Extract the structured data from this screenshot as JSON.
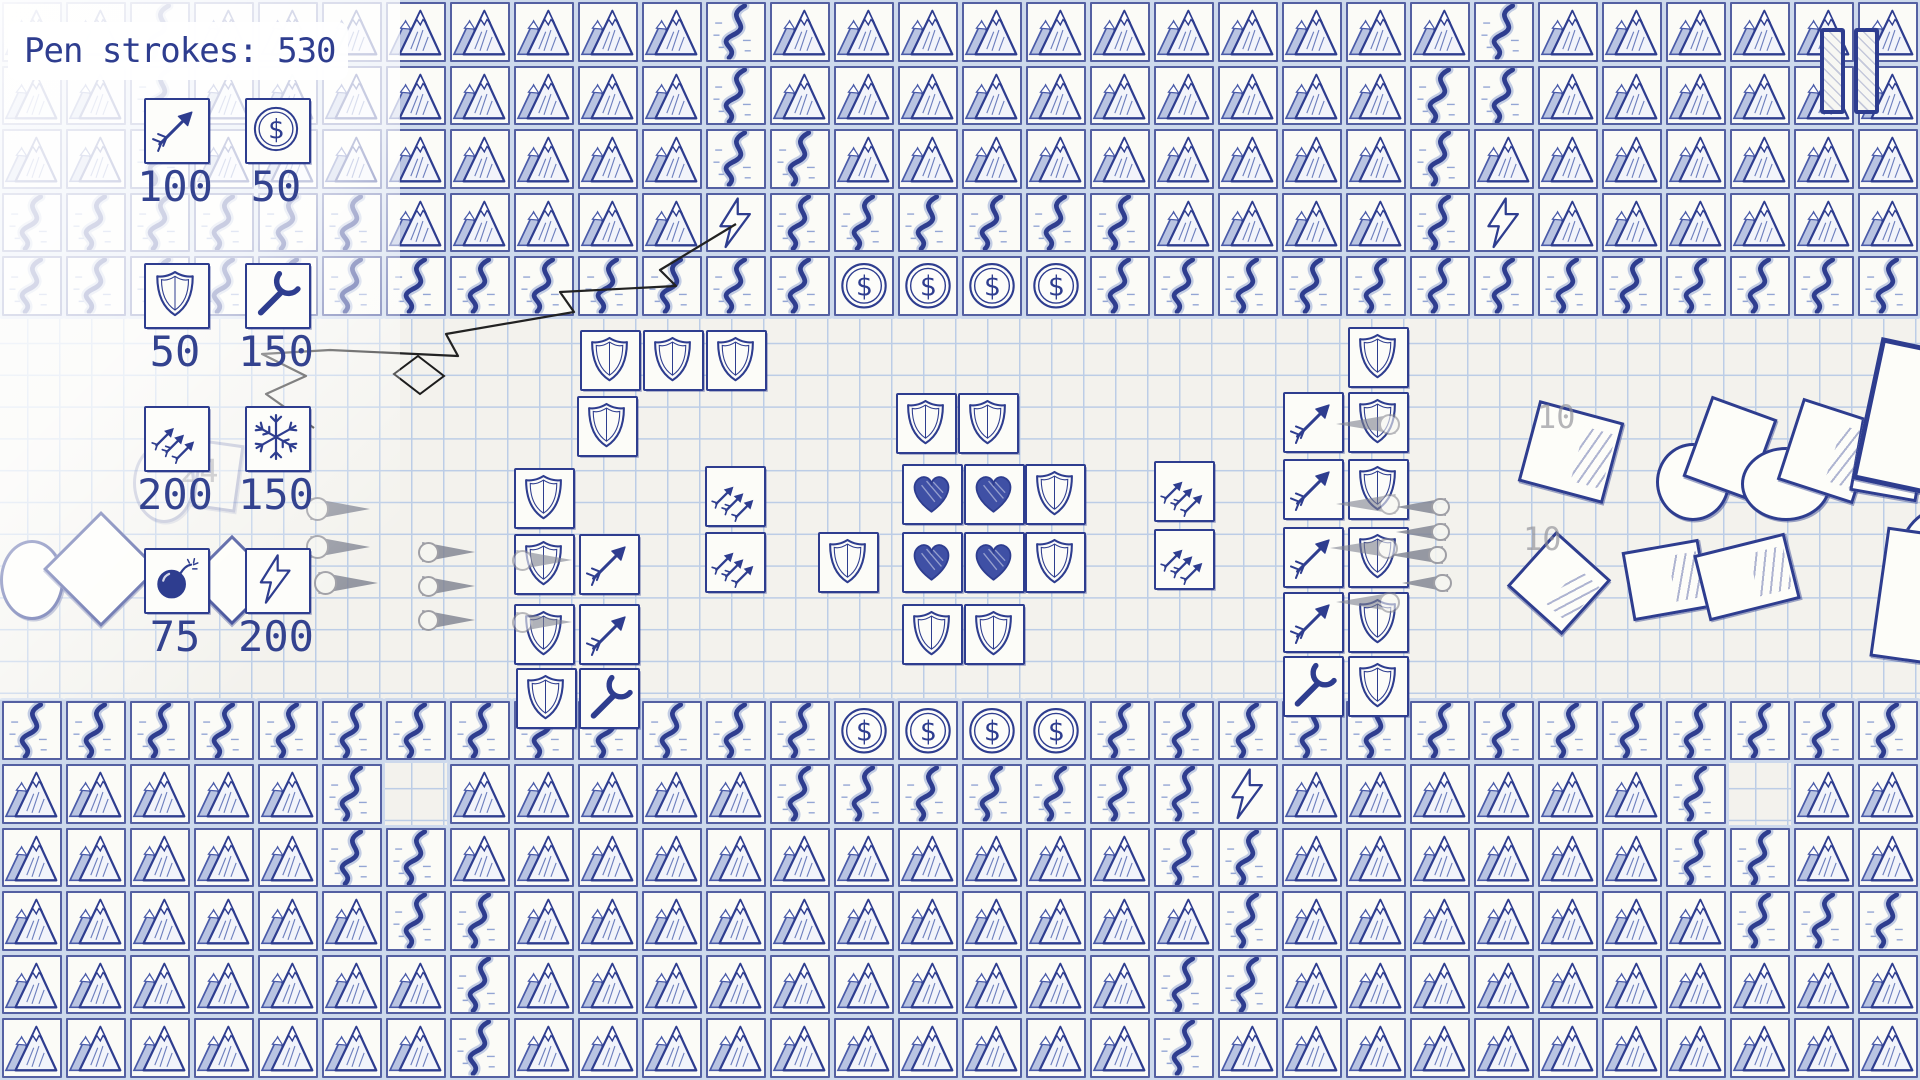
{
  "colors": {
    "ink": "#2e3d8f",
    "paper": "#f3f2ed",
    "grid_line": "#bccde6",
    "tape": "#cdd9ec",
    "dart_gray": "#7e8290",
    "faint_label": "#8f8f96"
  },
  "hud": {
    "pen_strokes": {
      "label": "Pen strokes: ",
      "value": "530"
    },
    "pause": {
      "icon": "pause-icon"
    }
  },
  "shop": {
    "items": [
      {
        "id": "arrow-tower",
        "icon": "arrow-icon",
        "price": "100",
        "x": 144,
        "y": 98
      },
      {
        "id": "coin",
        "icon": "dollar-coin-icon",
        "price": "50",
        "x": 245,
        "y": 98
      },
      {
        "id": "shield-wall",
        "icon": "shield-icon",
        "price": "50",
        "x": 144,
        "y": 263
      },
      {
        "id": "wrench-repair",
        "icon": "wrench-icon",
        "price": "150",
        "x": 245,
        "y": 263
      },
      {
        "id": "multi-arrow-tower",
        "icon": "triple-arrow-icon",
        "price": "200",
        "x": 144,
        "y": 406
      },
      {
        "id": "freeze",
        "icon": "snowflake-icon",
        "price": "150",
        "x": 245,
        "y": 406
      },
      {
        "id": "bomb",
        "icon": "bomb-icon",
        "price": "75",
        "x": 144,
        "y": 548
      },
      {
        "id": "lightning-tower",
        "icon": "lightning-icon",
        "price": "200",
        "x": 245,
        "y": 548
      }
    ]
  },
  "map": {
    "cols": 30,
    "rows": 17,
    "tile_w": 64,
    "tile_h": 63.53,
    "legend": {
      "M": "mountain",
      "R": "river",
      "C": "coin",
      "L": "lightning-tower",
      "P": "paper"
    },
    "grid": [
      "MMRMMMMMMMMRMMMMMMMMMMMRMMMMMM",
      "MMRMMMMMMMMRMMMMMMMMMMRRMMMMMM",
      "MMRMMMMMMMMRRMMMMMMMMMRMMMMMMM",
      "RRRRRRMMMMMLRRRRRRMMMMRLMMMMMM",
      "RRRRRRRRRRRRRCCCCRRRRRRRRRRRRR",
      "PPPPPPPPPPPPPPPPPPPPPPPPPPPPPP",
      "PPPPPPPPPPPPPPPPPPPPPPPPPPPPPP",
      "PPPPPPPPPPPPPPPPPPPPPPPPPPPPPP",
      "PPPPPPPPPPPPPPPPPPPPPPPPPPPPPP",
      "PPPPPPPPPPPPPPPPPPPPPPPPPPPPPP",
      "PPPPPPPPPPPPPPPPPPPPPPPPPPPPPP",
      "RRRRRRRRRRRRRCCCCRRRRRRRRRRRRR",
      "MMMMMRPMMMMMRRRRRRRLMMMMMMRPMM",
      "MMMMMRRMMMMMMMMMMMRRMMMMMMRRMM",
      "MMMMMMRRMMMMMMMMMMMRMMMMMMMRRR",
      "MMMMMMMRMMMMMMMMMMRRMMMMMMMMMM",
      "MMMMMMMRMMMMMMMMMMRMMMMMMMMMMM"
    ]
  },
  "towers": [
    {
      "t": "shield",
      "x": 580,
      "y": 330
    },
    {
      "t": "shield",
      "x": 643,
      "y": 330
    },
    {
      "t": "shield",
      "x": 706,
      "y": 330
    },
    {
      "t": "shield",
      "x": 577,
      "y": 396
    },
    {
      "t": "shield",
      "x": 514,
      "y": 468
    },
    {
      "t": "shield",
      "x": 514,
      "y": 534
    },
    {
      "t": "arrow",
      "x": 579,
      "y": 534
    },
    {
      "t": "shield",
      "x": 514,
      "y": 604
    },
    {
      "t": "arrow",
      "x": 579,
      "y": 604
    },
    {
      "t": "shield",
      "x": 516,
      "y": 668
    },
    {
      "t": "wrench",
      "x": 579,
      "y": 668
    },
    {
      "t": "multiarrow",
      "x": 705,
      "y": 466
    },
    {
      "t": "multiarrow",
      "x": 705,
      "y": 532
    },
    {
      "t": "shield",
      "x": 896,
      "y": 393
    },
    {
      "t": "shield",
      "x": 958,
      "y": 393
    },
    {
      "t": "heart",
      "x": 902,
      "y": 464
    },
    {
      "t": "heart",
      "x": 964,
      "y": 464
    },
    {
      "t": "shield",
      "x": 1025,
      "y": 464
    },
    {
      "t": "shield",
      "x": 818,
      "y": 532
    },
    {
      "t": "heart",
      "x": 902,
      "y": 532
    },
    {
      "t": "heart",
      "x": 964,
      "y": 532
    },
    {
      "t": "shield",
      "x": 1025,
      "y": 532
    },
    {
      "t": "shield",
      "x": 902,
      "y": 604
    },
    {
      "t": "shield",
      "x": 964,
      "y": 604
    },
    {
      "t": "multiarrow",
      "x": 1154,
      "y": 461
    },
    {
      "t": "multiarrow",
      "x": 1154,
      "y": 529
    },
    {
      "t": "arrow",
      "x": 1283,
      "y": 392
    },
    {
      "t": "arrow",
      "x": 1283,
      "y": 459
    },
    {
      "t": "arrow",
      "x": 1283,
      "y": 527
    },
    {
      "t": "arrow",
      "x": 1283,
      "y": 592
    },
    {
      "t": "wrench",
      "x": 1283,
      "y": 656
    },
    {
      "t": "shield",
      "x": 1348,
      "y": 327
    },
    {
      "t": "shield",
      "x": 1348,
      "y": 392
    },
    {
      "t": "shield",
      "x": 1348,
      "y": 459
    },
    {
      "t": "shield",
      "x": 1348,
      "y": 527
    },
    {
      "t": "shield",
      "x": 1348,
      "y": 592
    },
    {
      "t": "shield",
      "x": 1348,
      "y": 656
    }
  ],
  "enemies": {
    "darts": [
      {
        "x": 308,
        "y": 498,
        "w": 62,
        "h": 22,
        "dir": "left",
        "on": false
      },
      {
        "x": 308,
        "y": 536,
        "w": 62,
        "h": 22,
        "dir": "left",
        "on": false
      },
      {
        "x": 316,
        "y": 572,
        "w": 62,
        "h": 22,
        "dir": "left",
        "on": false
      },
      {
        "x": 420,
        "y": 542,
        "w": 55,
        "h": 20,
        "dir": "left",
        "on": false
      },
      {
        "x": 420,
        "y": 576,
        "w": 55,
        "h": 20,
        "dir": "left",
        "on": false
      },
      {
        "x": 420,
        "y": 610,
        "w": 55,
        "h": 20,
        "dir": "left",
        "on": false
      },
      {
        "x": 514,
        "y": 550,
        "w": 58,
        "h": 20,
        "dir": "left",
        "on": true
      },
      {
        "x": 514,
        "y": 612,
        "w": 58,
        "h": 20,
        "dir": "left",
        "on": true
      },
      {
        "x": 1396,
        "y": 498,
        "w": 52,
        "h": 18,
        "dir": "right",
        "on": false
      },
      {
        "x": 1396,
        "y": 523,
        "w": 52,
        "h": 18,
        "dir": "right",
        "on": false
      },
      {
        "x": 1390,
        "y": 546,
        "w": 55,
        "h": 18,
        "dir": "right",
        "on": false
      },
      {
        "x": 1402,
        "y": 574,
        "w": 48,
        "h": 18,
        "dir": "right",
        "on": false
      },
      {
        "x": 1336,
        "y": 414,
        "w": 62,
        "h": 20,
        "dir": "right",
        "on": true
      },
      {
        "x": 1336,
        "y": 494,
        "w": 62,
        "h": 20,
        "dir": "right",
        "on": true
      },
      {
        "x": 1330,
        "y": 538,
        "w": 66,
        "h": 20,
        "dir": "right",
        "on": true
      },
      {
        "x": 1336,
        "y": 592,
        "w": 62,
        "h": 20,
        "dir": "right",
        "on": true
      }
    ],
    "shapes": [
      {
        "t": "circle",
        "x": 0,
        "y": 540,
        "w": 58,
        "h": 74,
        "rot": 0,
        "cls": ""
      },
      {
        "t": "square",
        "x": 60,
        "y": 528,
        "w": 76,
        "h": 76,
        "rot": 45,
        "cls": ""
      },
      {
        "t": "square",
        "x": 200,
        "y": 548,
        "w": 58,
        "h": 58,
        "rot": 45,
        "cls": ""
      },
      {
        "t": "circle",
        "x": 133,
        "y": 443,
        "w": 56,
        "h": 74,
        "rot": 0,
        "cls": "faded"
      },
      {
        "t": "square",
        "x": 196,
        "y": 442,
        "w": 38,
        "h": 62,
        "rot": 8,
        "cls": "faded"
      },
      {
        "t": "square",
        "x": 1527,
        "y": 410,
        "w": 82,
        "h": 78,
        "rot": 15,
        "cls": "hatch"
      },
      {
        "t": "square",
        "x": 1522,
        "y": 546,
        "w": 68,
        "h": 68,
        "rot": 42,
        "cls": "hatch"
      },
      {
        "t": "square",
        "x": 1627,
        "y": 545,
        "w": 72,
        "h": 64,
        "rot": -10,
        "cls": "hatch"
      },
      {
        "t": "circle",
        "x": 1656,
        "y": 443,
        "w": 68,
        "h": 72,
        "rot": 0,
        "cls": ""
      },
      {
        "t": "square",
        "x": 1695,
        "y": 405,
        "w": 64,
        "h": 80,
        "rot": 20,
        "cls": ""
      },
      {
        "t": "circle",
        "x": 1741,
        "y": 447,
        "w": 84,
        "h": 68,
        "rot": 0,
        "cls": ""
      },
      {
        "t": "square",
        "x": 1788,
        "y": 408,
        "w": 74,
        "h": 80,
        "rot": 18,
        "cls": "hatch"
      },
      {
        "t": "square",
        "x": 1855,
        "y": 425,
        "w": 62,
        "h": 66,
        "rot": 10,
        "cls": ""
      },
      {
        "t": "square",
        "x": 1865,
        "y": 350,
        "w": 130,
        "h": 135,
        "rot": 12,
        "cls": "thick"
      },
      {
        "t": "square",
        "x": 1700,
        "y": 543,
        "w": 88,
        "h": 62,
        "rot": -14,
        "cls": "hatch"
      },
      {
        "t": "circle",
        "x": 1898,
        "y": 505,
        "w": 95,
        "h": 100,
        "rot": 0,
        "cls": ""
      },
      {
        "t": "square",
        "x": 1878,
        "y": 533,
        "w": 95,
        "h": 125,
        "rot": 8,
        "cls": ""
      }
    ]
  },
  "effects": {
    "zap_points": "736,224 660,270 676,286 560,292 574,312 446,334 458,356 330,350 262,354 306,376 266,394 314,428",
    "zap_diamond": "M418 356 L444 376 L420 394 L394 374 Z",
    "labels": [
      {
        "text": "10",
        "x": 1537,
        "y": 398
      },
      {
        "text": "10",
        "x": 1523,
        "y": 520
      },
      {
        "text": "24",
        "x": 180,
        "y": 452
      }
    ]
  }
}
